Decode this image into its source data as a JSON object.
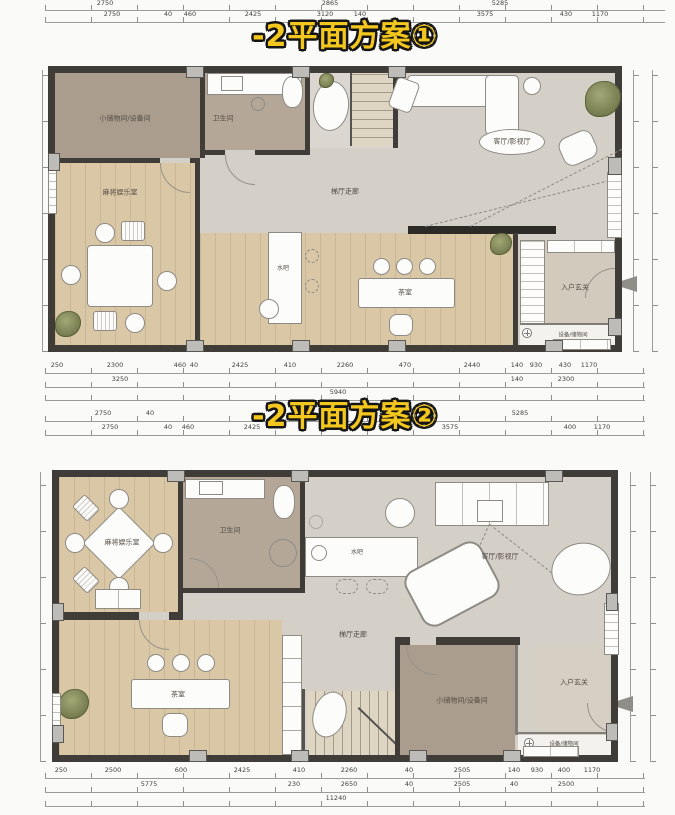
{
  "titles": {
    "plan1": "-2平面方案①",
    "plan2": "-2平面方案②"
  },
  "colors": {
    "title_fill": "#f3c71e",
    "title_outline": "#151515",
    "wall": "#403d39",
    "column_fill": "#bdbcb9",
    "wood_floor": "#d9c7a6",
    "tile_floor": "#d4d0c8",
    "taupe_floor": "#ab9d8e",
    "bath_floor": "#b4a798",
    "furniture": "#fcfcfb",
    "plant": "#5f663c",
    "dimension_text": "#3f3f3f"
  },
  "icons": {
    "floor_drain": "circle-with-cross",
    "door_swing": "quarter-arc",
    "entry_marker": "gray-wedge"
  },
  "plan1": {
    "rooms": {
      "storage": "小储物间/设备间",
      "bathroom": "卫生间",
      "mahjong": "麻将娱乐室",
      "living": "客厅/影视厅",
      "corridor": "梯厅走廊",
      "water_bar": "水吧",
      "tea": "茶室",
      "foyer": "入户玄关",
      "utility": "设备/储物间"
    },
    "dims": {
      "top1": [
        "2750",
        "2865",
        "5285"
      ],
      "top2": [
        "2750",
        "40",
        "460",
        "2425",
        "3120",
        "140",
        "3575",
        "430",
        "1170"
      ],
      "bottom1": [
        "250",
        "2300",
        "460",
        "40",
        "2425",
        "410",
        "2260",
        "470",
        "2440",
        "140",
        "930",
        "430",
        "1170"
      ],
      "bottom2": [
        "3250",
        "140",
        "2300"
      ],
      "bottom3": [
        "5940"
      ]
    }
  },
  "plan2": {
    "rooms": {
      "storage": "小储物间/设备间",
      "bathroom": "卫生间",
      "mahjong": "麻将娱乐室",
      "living": "客厅/影视厅",
      "corridor": "梯厅走廊",
      "water_bar": "水吧",
      "tea": "茶室",
      "foyer": "入户玄关",
      "utility": "设备/储物间"
    },
    "dims": {
      "top1": [
        "2750",
        "40",
        "5285"
      ],
      "top2": [
        "2750",
        "40",
        "460",
        "2425",
        "3575",
        "400",
        "1170"
      ],
      "bottom1": [
        "250",
        "2500",
        "600",
        "2425",
        "410",
        "2260",
        "40",
        "2505",
        "140",
        "930",
        "400",
        "1170"
      ],
      "bottom2": [
        "5775",
        "230",
        "2650",
        "40",
        "2505",
        "40",
        "2500"
      ],
      "bottom3": [
        "11240"
      ]
    }
  }
}
